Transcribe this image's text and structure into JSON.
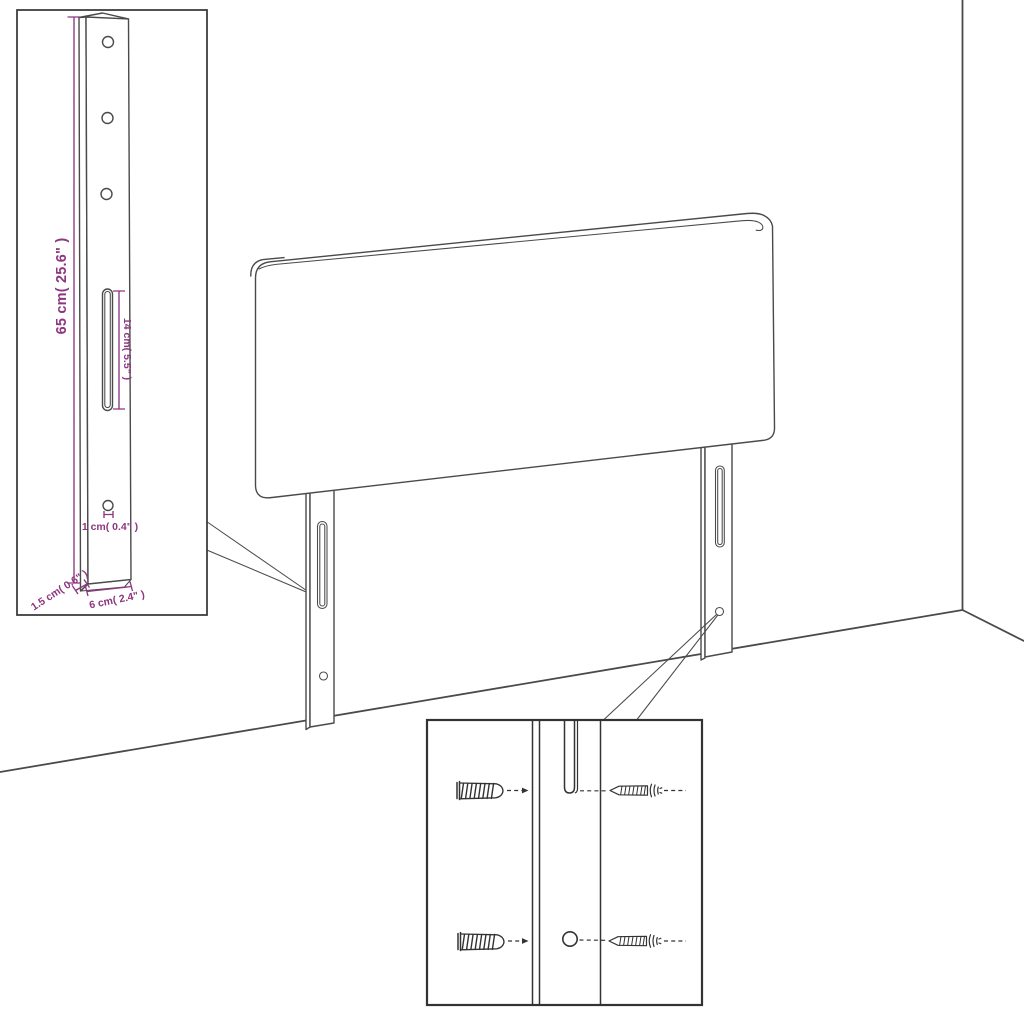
{
  "colors": {
    "background": "#ffffff",
    "line": "#4a4a4a",
    "line-strong": "#333333",
    "dimension": "#8e3680"
  },
  "leg_detail_inset": {
    "height_label": "65 cm( 25.6\" )",
    "slot_label": "14 cm( 5.5\" )",
    "hole_label": "1 cm( 0.4\" )",
    "thickness_label": "1.5 cm( 0.6\" )",
    "width_label": "6 cm( 2.4\" )"
  }
}
